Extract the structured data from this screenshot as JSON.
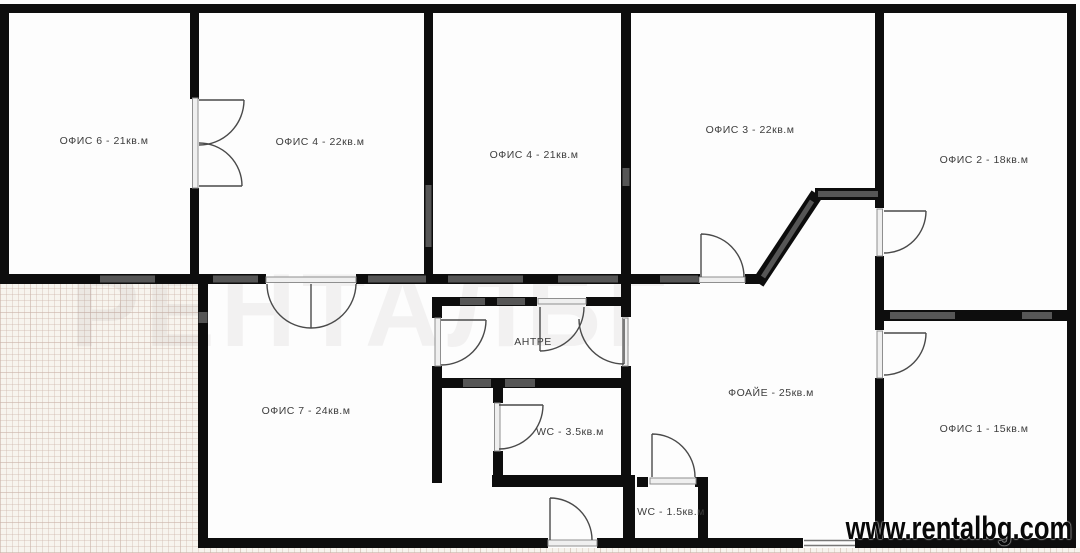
{
  "rooms": {
    "office6": {
      "label": "ОФИС 6 - 21кв.м"
    },
    "office4a": {
      "label": "ОФИС 4 - 22кв.м"
    },
    "office4b": {
      "label": "ОФИС 4 - 21кв.м"
    },
    "office3": {
      "label": "ОФИС 3 - 22кв.м"
    },
    "office2": {
      "label": "ОФИС 2 - 18кв.м"
    },
    "office7": {
      "label": "ОФИС 7 - 24кв.м"
    },
    "antre": {
      "label": "АНТРЕ"
    },
    "wc_large": {
      "label": "WC - 3.5кв.м"
    },
    "foyer": {
      "label": "ФОАЙЕ - 25кв.м"
    },
    "wc_small": {
      "label": "WC - 1.5кв.м"
    },
    "office1": {
      "label": "ОФИС 1 - 15кв.м"
    }
  },
  "watermark": {
    "site": "www.rentalbg.com"
  },
  "ghost_watermark": "РЕНТАЛБГ",
  "colors": {
    "wall": "#0d0d0d",
    "window_segment": "#565656",
    "door_stroke": "#4a4a4a",
    "exterior_grid_bg": "#f7f4ee",
    "watermark_text": "#080808"
  }
}
